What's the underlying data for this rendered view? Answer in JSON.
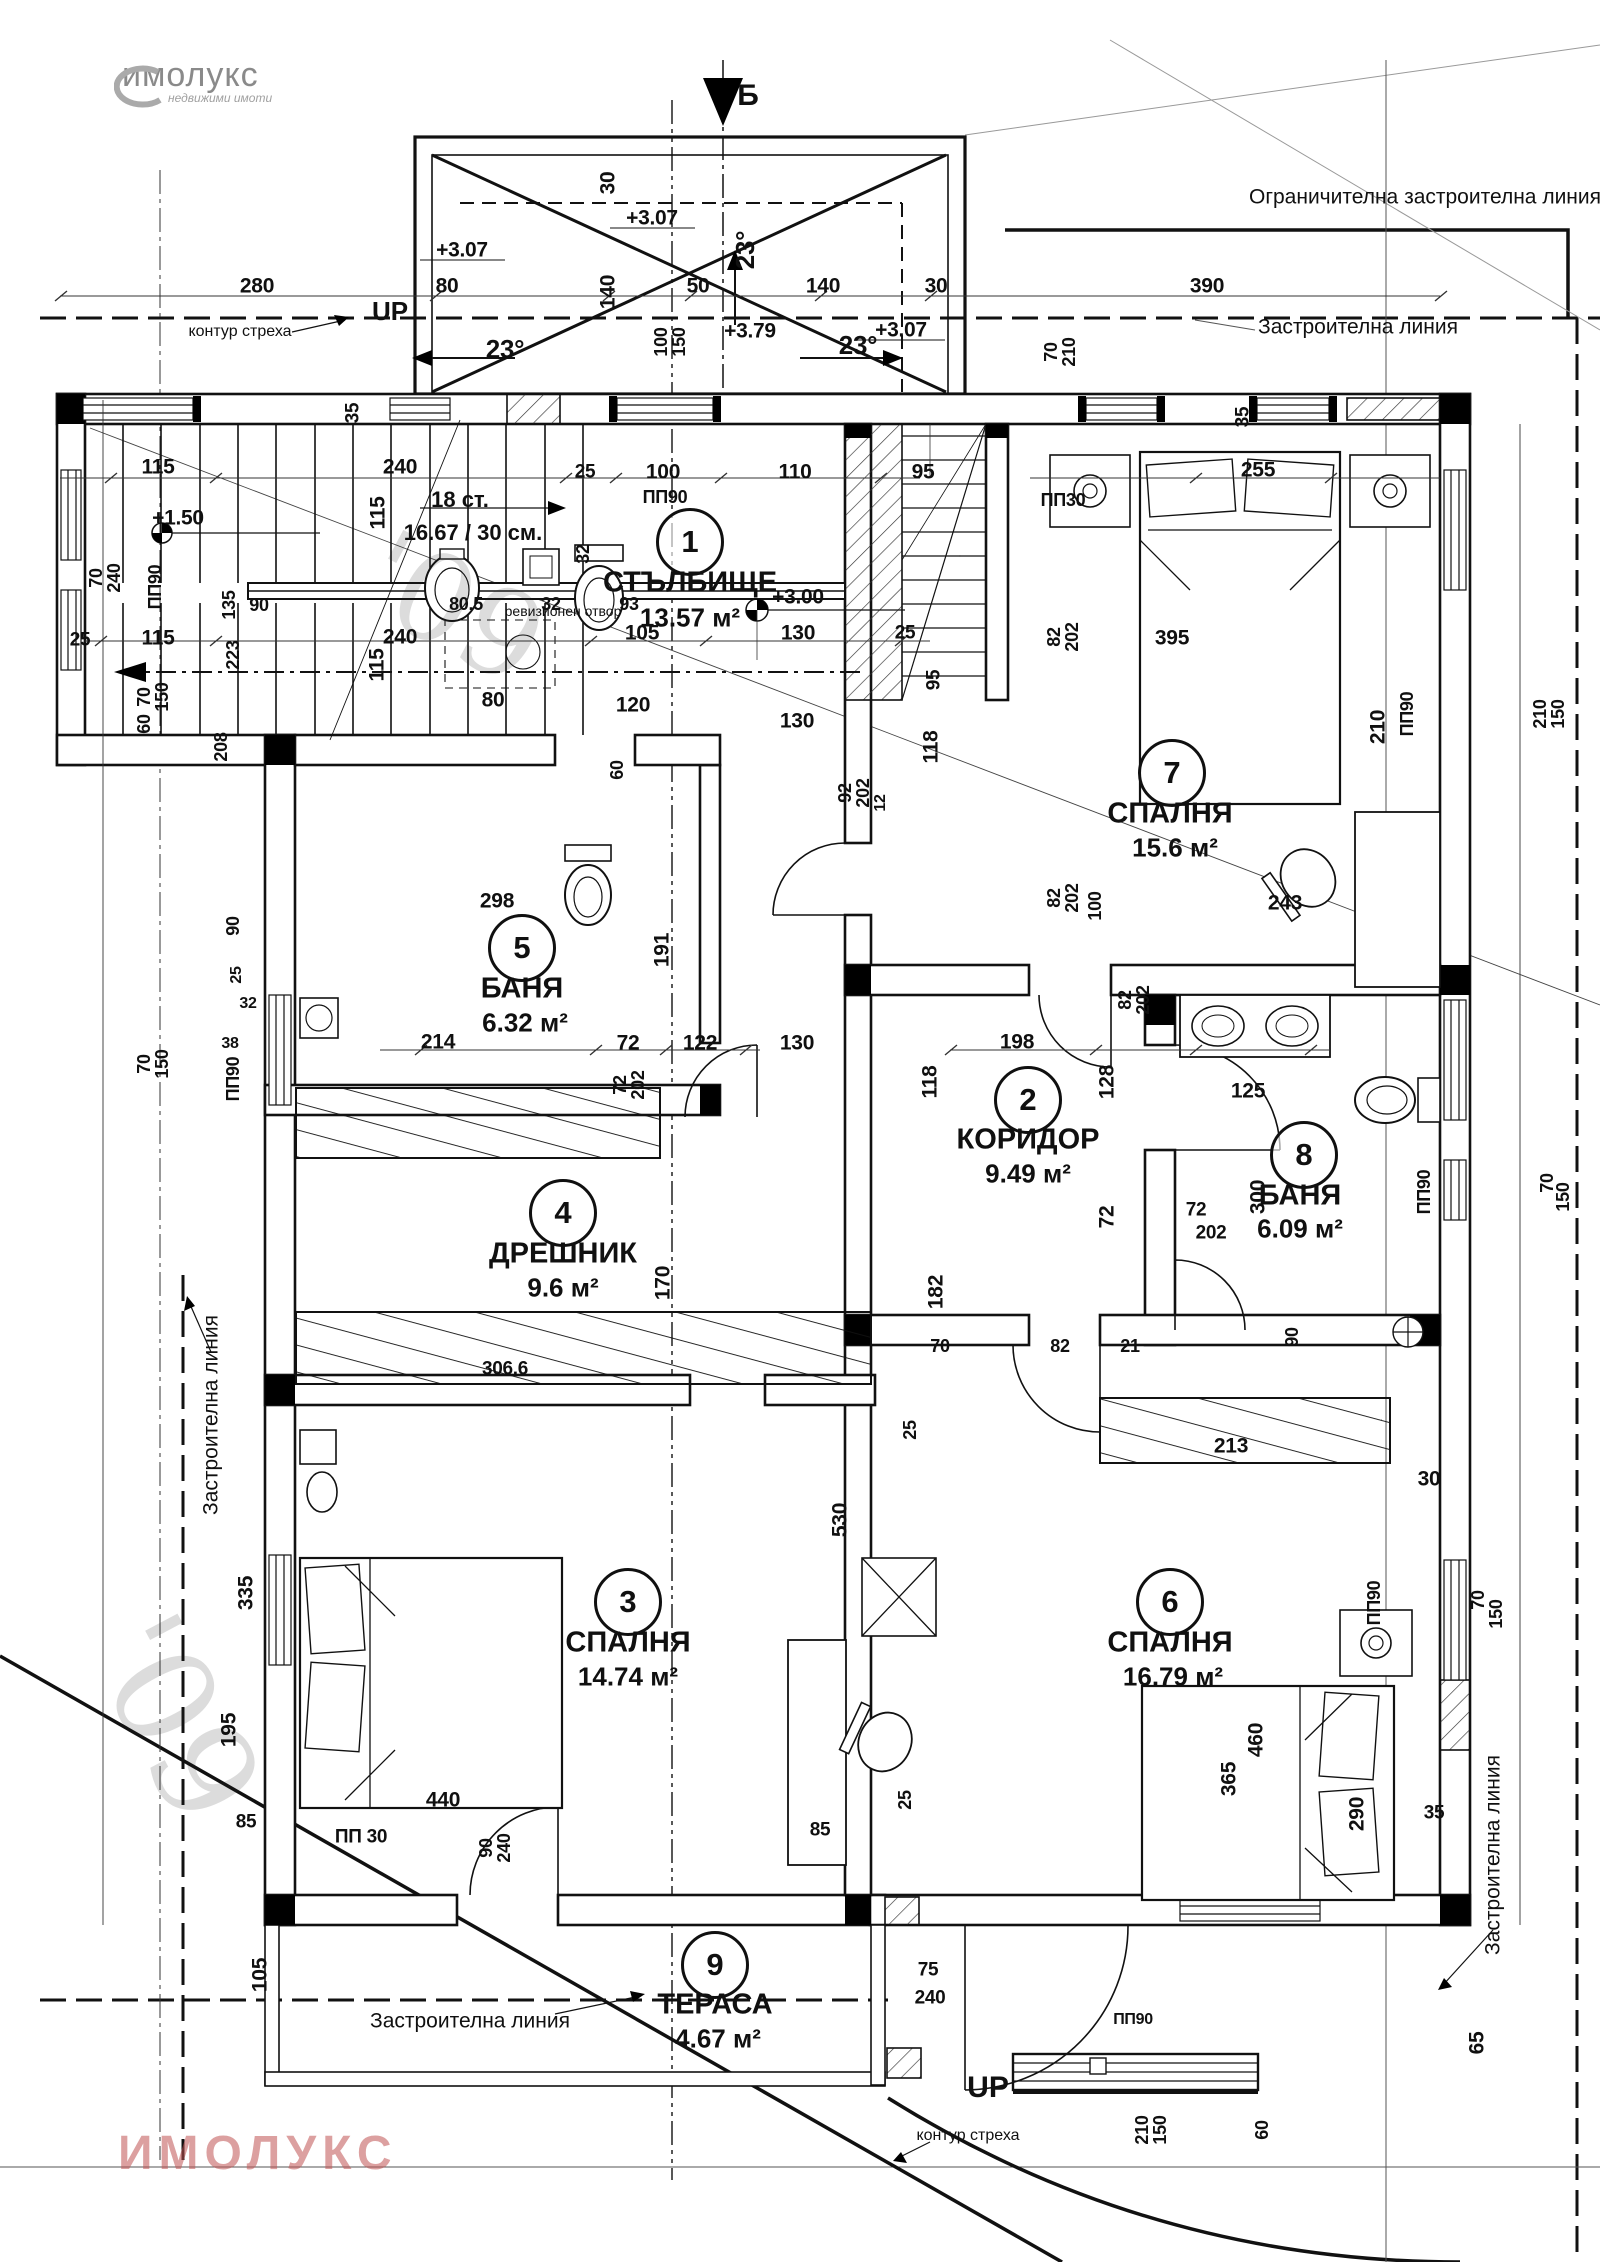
{
  "logo": {
    "name": "имолукс",
    "tagline": "недвижими имоти"
  },
  "watermark": "ИМОЛУКС",
  "handwriting": {
    "a": "'09",
    "b": "'09"
  },
  "north_mark": {
    "letter": "Б"
  },
  "rooms": [
    {
      "num": "1",
      "name": "СТЪЛБИЩЕ",
      "area": "13.57 м²",
      "cx": 690,
      "cy": 542,
      "nx": 690,
      "ny": 583,
      "ax": 690,
      "ay": 618
    },
    {
      "num": "2",
      "name": "КОРИДОР",
      "area": "9.49 м²",
      "cx": 1028,
      "cy": 1100,
      "nx": 1028,
      "ny": 1140,
      "ax": 1028,
      "ay": 1174
    },
    {
      "num": "3",
      "name": "СПАЛНЯ",
      "area": "14.74 м²",
      "cx": 628,
      "cy": 1602,
      "nx": 628,
      "ny": 1643,
      "ax": 628,
      "ay": 1677
    },
    {
      "num": "4",
      "name": "ДРЕШНИК",
      "area": "9.6 м²",
      "cx": 563,
      "cy": 1213,
      "nx": 563,
      "ny": 1254,
      "ax": 563,
      "ay": 1288
    },
    {
      "num": "5",
      "name": "БАНЯ",
      "area": "6.32 м²",
      "cx": 522,
      "cy": 948,
      "nx": 522,
      "ny": 989,
      "ax": 525,
      "ay": 1023
    },
    {
      "num": "6",
      "name": "СПАЛНЯ",
      "area": "16.79 м²",
      "cx": 1170,
      "cy": 1602,
      "nx": 1170,
      "ny": 1643,
      "ax": 1173,
      "ay": 1677
    },
    {
      "num": "7",
      "name": "СПАЛНЯ",
      "area": "15.6 м²",
      "cx": 1172,
      "cy": 773,
      "nx": 1170,
      "ny": 814,
      "ax": 1175,
      "ay": 848
    },
    {
      "num": "8",
      "name": "БАНЯ",
      "area": "6.09 м²",
      "cx": 1304,
      "cy": 1155,
      "nx": 1300,
      "ny": 1196,
      "ax": 1300,
      "ay": 1229
    },
    {
      "num": "9",
      "name": "ТЕРАСА",
      "area": "4.67 м²",
      "cx": 715,
      "cy": 1965,
      "nx": 715,
      "ny": 2005,
      "ax": 718,
      "ay": 2039
    }
  ],
  "annotations": [
    {
      "t": "Ограничителна застроителна линия",
      "x": 1425,
      "y": 197
    },
    {
      "t": "Застроителна линия",
      "x": 1358,
      "y": 327
    },
    {
      "t": "Застроителна линия",
      "x": 211,
      "y": 1415,
      "r": -90
    },
    {
      "t": "Застроителна линия",
      "x": 1493,
      "y": 1855,
      "r": -90
    },
    {
      "t": "Застроителна линия",
      "x": 470,
      "y": 2021
    },
    {
      "t": "контур стреха",
      "x": 240,
      "y": 332,
      "s": 16
    },
    {
      "t": "контур стреха",
      "x": 968,
      "y": 2136,
      "s": 16
    },
    {
      "t": "UP",
      "x": 390,
      "y": 311,
      "s": 26,
      "b": 1
    },
    {
      "t": "UP",
      "x": 988,
      "y": 2088,
      "s": 30,
      "b": 1
    },
    {
      "t": "Б",
      "x": 748,
      "y": 96,
      "s": 30,
      "b": 1
    },
    {
      "t": "ревизионен отвор",
      "x": 563,
      "y": 611,
      "s": 14
    },
    {
      "t": "18 ст.",
      "x": 460,
      "y": 500,
      "s": 22,
      "b": 1
    },
    {
      "t": "16.67 / 30 см.",
      "x": 473,
      "y": 533,
      "s": 22,
      "b": 1
    }
  ],
  "dims": [
    {
      "t": "280",
      "x": 257,
      "y": 286
    },
    {
      "t": "80",
      "x": 447,
      "y": 286
    },
    {
      "t": "30",
      "x": 608,
      "y": 183,
      "r": -90
    },
    {
      "t": "140",
      "x": 608,
      "y": 292,
      "r": -90
    },
    {
      "t": "50",
      "x": 698,
      "y": 286
    },
    {
      "t": "140",
      "x": 823,
      "y": 286
    },
    {
      "t": "30",
      "x": 936,
      "y": 286
    },
    {
      "t": "390",
      "x": 1207,
      "y": 286
    },
    {
      "t": "+3.07",
      "x": 462,
      "y": 250
    },
    {
      "t": "+3.07",
      "x": 652,
      "y": 218
    },
    {
      "t": "+3.07",
      "x": 901,
      "y": 330
    },
    {
      "t": "+3.79",
      "x": 750,
      "y": 331
    },
    {
      "t": "23°",
      "x": 745,
      "y": 250,
      "r": -90,
      "s": 26
    },
    {
      "t": "23°",
      "x": 505,
      "y": 349,
      "s": 26
    },
    {
      "t": "23°",
      "x": 858,
      "y": 345,
      "s": 26
    },
    {
      "t": "100",
      "x": 661,
      "y": 342,
      "r": -90,
      "s": 18
    },
    {
      "t": "150",
      "x": 679,
      "y": 342,
      "r": -90,
      "s": 18
    },
    {
      "t": "70",
      "x": 1051,
      "y": 352,
      "r": -90,
      "s": 18
    },
    {
      "t": "210",
      "x": 1069,
      "y": 352,
      "r": -90,
      "s": 18
    },
    {
      "t": "35",
      "x": 353,
      "y": 413,
      "r": -90,
      "s": 19
    },
    {
      "t": "35",
      "x": 1243,
      "y": 417,
      "r": -90,
      "s": 19
    },
    {
      "t": "115",
      "x": 158,
      "y": 467
    },
    {
      "t": "240",
      "x": 400,
      "y": 467
    },
    {
      "t": "25",
      "x": 585,
      "y": 472,
      "s": 19
    },
    {
      "t": "100",
      "x": 663,
      "y": 472
    },
    {
      "t": "110",
      "x": 795,
      "y": 472
    },
    {
      "t": "95",
      "x": 923,
      "y": 472
    },
    {
      "t": "255",
      "x": 1258,
      "y": 470
    },
    {
      "t": "ПП90",
      "x": 665,
      "y": 497,
      "s": 18
    },
    {
      "t": "ПП30",
      "x": 1063,
      "y": 500,
      "s": 18
    },
    {
      "t": "ПП90",
      "x": 155,
      "y": 587,
      "r": -90,
      "s": 18
    },
    {
      "t": "+1.50",
      "x": 178,
      "y": 518
    },
    {
      "t": "115",
      "x": 378,
      "y": 513,
      "r": -90
    },
    {
      "t": "115",
      "x": 158,
      "y": 638
    },
    {
      "t": "240",
      "x": 400,
      "y": 637
    },
    {
      "t": "25",
      "x": 80,
      "y": 640,
      "s": 19
    },
    {
      "t": "115",
      "x": 377,
      "y": 665,
      "r": -90
    },
    {
      "t": "+3.00",
      "x": 798,
      "y": 597
    },
    {
      "t": "105",
      "x": 642,
      "y": 633
    },
    {
      "t": "130",
      "x": 798,
      "y": 633
    },
    {
      "t": "25",
      "x": 905,
      "y": 633,
      "s": 19
    },
    {
      "t": "120",
      "x": 633,
      "y": 705
    },
    {
      "t": "80",
      "x": 493,
      "y": 700
    },
    {
      "t": "95",
      "x": 934,
      "y": 680,
      "r": -90,
      "s": 19
    },
    {
      "t": "70",
      "x": 96,
      "y": 578,
      "r": -90,
      "s": 18
    },
    {
      "t": "240",
      "x": 114,
      "y": 578,
      "r": -90,
      "s": 18
    },
    {
      "t": "70",
      "x": 144,
      "y": 697,
      "r": -90,
      "s": 18
    },
    {
      "t": "150",
      "x": 162,
      "y": 697,
      "r": -90,
      "s": 18
    },
    {
      "t": "60",
      "x": 144,
      "y": 724,
      "r": -90,
      "s": 18
    },
    {
      "t": "208",
      "x": 221,
      "y": 747,
      "r": -90,
      "s": 18
    },
    {
      "t": "135",
      "x": 229,
      "y": 605,
      "r": -90,
      "s": 18
    },
    {
      "t": "90",
      "x": 259,
      "y": 605,
      "s": 18
    },
    {
      "t": "223",
      "x": 233,
      "y": 655,
      "r": -90,
      "s": 18
    },
    {
      "t": "80.5",
      "x": 466,
      "y": 604,
      "s": 18
    },
    {
      "t": "32",
      "x": 551,
      "y": 604,
      "s": 18
    },
    {
      "t": "93",
      "x": 629,
      "y": 604,
      "s": 18
    },
    {
      "t": "32",
      "x": 583,
      "y": 554,
      "r": -90,
      "s": 18
    },
    {
      "t": "298",
      "x": 497,
      "y": 901
    },
    {
      "t": "214",
      "x": 438,
      "y": 1042
    },
    {
      "t": "191",
      "x": 662,
      "y": 950,
      "r": -90
    },
    {
      "t": "72",
      "x": 628,
      "y": 1043
    },
    {
      "t": "72",
      "x": 620,
      "y": 1085,
      "r": -90,
      "s": 18
    },
    {
      "t": "202",
      "x": 638,
      "y": 1085,
      "r": -90,
      "s": 18
    },
    {
      "t": "122",
      "x": 700,
      "y": 1043
    },
    {
      "t": "60",
      "x": 617,
      "y": 770,
      "r": -90,
      "s": 18
    },
    {
      "t": "92",
      "x": 845,
      "y": 793,
      "r": -90,
      "s": 18
    },
    {
      "t": "202",
      "x": 863,
      "y": 793,
      "r": -90,
      "s": 18
    },
    {
      "t": "12",
      "x": 881,
      "y": 803,
      "r": -90,
      "s": 16
    },
    {
      "t": "130",
      "x": 797,
      "y": 721
    },
    {
      "t": "130",
      "x": 797,
      "y": 1043
    },
    {
      "t": "118",
      "x": 931,
      "y": 747,
      "r": -90
    },
    {
      "t": "118",
      "x": 930,
      "y": 1082,
      "r": -90
    },
    {
      "t": "198",
      "x": 1017,
      "y": 1042
    },
    {
      "t": "128",
      "x": 1107,
      "y": 1082,
      "r": -90
    },
    {
      "t": "72",
      "x": 1107,
      "y": 1217,
      "r": -90
    },
    {
      "t": "72",
      "x": 1196,
      "y": 1210,
      "s": 19
    },
    {
      "t": "202",
      "x": 1211,
      "y": 1233,
      "s": 19
    },
    {
      "t": "125",
      "x": 1248,
      "y": 1091
    },
    {
      "t": "300",
      "x": 1258,
      "y": 1197,
      "r": -90
    },
    {
      "t": "90",
      "x": 1292,
      "y": 1337,
      "r": -90,
      "s": 18
    },
    {
      "t": "ПП90",
      "x": 1424,
      "y": 1192,
      "r": -90,
      "s": 18
    },
    {
      "t": "70",
      "x": 1547,
      "y": 1183,
      "r": -90,
      "s": 18
    },
    {
      "t": "150",
      "x": 1563,
      "y": 1197,
      "r": -90,
      "s": 18
    },
    {
      "t": "82",
      "x": 1054,
      "y": 637,
      "r": -90,
      "s": 18
    },
    {
      "t": "202",
      "x": 1072,
      "y": 637,
      "r": -90,
      "s": 18
    },
    {
      "t": "82",
      "x": 1054,
      "y": 898,
      "r": -90,
      "s": 18
    },
    {
      "t": "202",
      "x": 1072,
      "y": 898,
      "r": -90,
      "s": 18
    },
    {
      "t": "82",
      "x": 1125,
      "y": 1000,
      "r": -90,
      "s": 18
    },
    {
      "t": "202",
      "x": 1143,
      "y": 1000,
      "r": -90,
      "s": 18
    },
    {
      "t": "100",
      "x": 1095,
      "y": 906,
      "r": -90,
      "s": 18
    },
    {
      "t": "70",
      "x": 940,
      "y": 1346,
      "s": 18
    },
    {
      "t": "82",
      "x": 1060,
      "y": 1346,
      "s": 18
    },
    {
      "t": "21",
      "x": 1130,
      "y": 1346,
      "s": 18
    },
    {
      "t": "243",
      "x": 1285,
      "y": 903
    },
    {
      "t": "395",
      "x": 1172,
      "y": 638
    },
    {
      "t": "210",
      "x": 1378,
      "y": 727,
      "r": -90
    },
    {
      "t": "ПП90",
      "x": 1407,
      "y": 714,
      "r": -90,
      "s": 18
    },
    {
      "t": "210",
      "x": 1540,
      "y": 714,
      "r": -90,
      "s": 18
    },
    {
      "t": "150",
      "x": 1558,
      "y": 714,
      "r": -90,
      "s": 18
    },
    {
      "t": "170",
      "x": 663,
      "y": 1283,
      "r": -90
    },
    {
      "t": "306.6",
      "x": 505,
      "y": 1369,
      "s": 19
    },
    {
      "t": "182",
      "x": 936,
      "y": 1292,
      "r": -90
    },
    {
      "t": "90",
      "x": 233,
      "y": 926,
      "r": -90,
      "s": 18
    },
    {
      "t": "25",
      "x": 237,
      "y": 975,
      "r": -90,
      "s": 16
    },
    {
      "t": "32",
      "x": 248,
      "y": 1004,
      "s": 16
    },
    {
      "t": "38",
      "x": 230,
      "y": 1044,
      "s": 16
    },
    {
      "t": "70",
      "x": 144,
      "y": 1064,
      "r": -90,
      "s": 18
    },
    {
      "t": "150",
      "x": 162,
      "y": 1064,
      "r": -90,
      "s": 18
    },
    {
      "t": "ПП90",
      "x": 233,
      "y": 1079,
      "r": -90,
      "s": 18
    },
    {
      "t": "335",
      "x": 246,
      "y": 1593,
      "r": -90
    },
    {
      "t": "195",
      "x": 229,
      "y": 1730,
      "r": -90
    },
    {
      "t": "440",
      "x": 443,
      "y": 1800
    },
    {
      "t": "85",
      "x": 246,
      "y": 1822,
      "s": 19
    },
    {
      "t": "ПП 30",
      "x": 361,
      "y": 1837,
      "s": 19
    },
    {
      "t": "90",
      "x": 486,
      "y": 1848,
      "r": -90,
      "s": 18
    },
    {
      "t": "240",
      "x": 504,
      "y": 1848,
      "r": -90,
      "s": 18
    },
    {
      "t": "105",
      "x": 260,
      "y": 1975,
      "r": -90
    },
    {
      "t": "530",
      "x": 840,
      "y": 1520,
      "r": -90
    },
    {
      "t": "25",
      "x": 910,
      "y": 1430,
      "r": -90,
      "s": 18
    },
    {
      "t": "85",
      "x": 820,
      "y": 1830,
      "s": 19
    },
    {
      "t": "25",
      "x": 905,
      "y": 1800,
      "r": -90,
      "s": 18
    },
    {
      "t": "213",
      "x": 1231,
      "y": 1446
    },
    {
      "t": "30",
      "x": 1429,
      "y": 1479
    },
    {
      "t": "460",
      "x": 1256,
      "y": 1740,
      "r": -90
    },
    {
      "t": "365",
      "x": 1229,
      "y": 1779,
      "r": -90
    },
    {
      "t": "290",
      "x": 1357,
      "y": 1814,
      "r": -90
    },
    {
      "t": "ПП90",
      "x": 1374,
      "y": 1603,
      "r": -90,
      "s": 18
    },
    {
      "t": "70",
      "x": 1478,
      "y": 1600,
      "r": -90,
      "s": 18
    },
    {
      "t": "150",
      "x": 1496,
      "y": 1614,
      "r": -90,
      "s": 18
    },
    {
      "t": "35",
      "x": 1434,
      "y": 1813,
      "s": 19
    },
    {
      "t": "65",
      "x": 1477,
      "y": 2043,
      "r": -90
    },
    {
      "t": "75",
      "x": 928,
      "y": 1970,
      "s": 19
    },
    {
      "t": "240",
      "x": 930,
      "y": 1998,
      "s": 19
    },
    {
      "t": "210",
      "x": 1142,
      "y": 2130,
      "r": -90,
      "s": 18
    },
    {
      "t": "150",
      "x": 1160,
      "y": 2130,
      "r": -90,
      "s": 18
    },
    {
      "t": "60",
      "x": 1262,
      "y": 2130,
      "r": -90,
      "s": 18
    },
    {
      "t": "ПП90",
      "x": 1133,
      "y": 2020,
      "s": 16
    }
  ]
}
